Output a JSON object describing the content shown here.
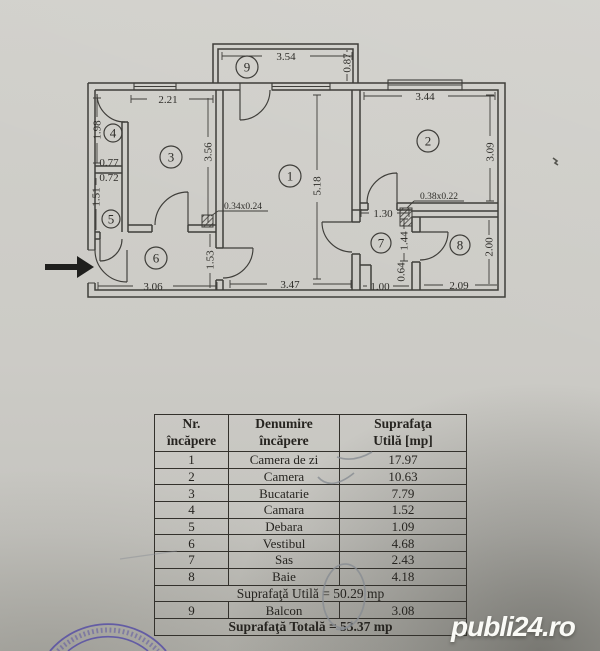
{
  "colors": {
    "paper": "#cbcac5",
    "ink": "#3f3e3a",
    "pen": "#878c92",
    "stamp": "#574fa4",
    "wm": "#fafaf6"
  },
  "watermark": {
    "text": "publi24.ro"
  },
  "plan": {
    "rooms": {
      "r1": "1",
      "r2": "2",
      "r3": "3",
      "r4": "4",
      "r5": "5",
      "r6": "6",
      "r7": "7",
      "r8": "8",
      "r9": "9"
    },
    "dims": {
      "balcony_width": "3.54",
      "balcony_depth": "0.87",
      "kitchen_width": "2.21",
      "kitchen_height": "3.56",
      "camara_height": "1.98",
      "camara_width": "0.77",
      "debara_width": "0.72",
      "debara_height": "1.51",
      "living_height": "5.18",
      "living_width": "3.47",
      "camera_width": "3.44",
      "camera_height": "3.09",
      "shaft_a": "0.34x0.24",
      "shaft_b": "0.38x0.22",
      "sas_width": "1.30",
      "sas_height_upper": "1.44",
      "sas_height_lower": "0.64",
      "sas_bottom_width": "1.00",
      "bath_width": "2.09",
      "bath_height": "2.00",
      "vestibul_height": "1.53",
      "vestibul_width": "3.06"
    }
  },
  "table": {
    "headers": [
      {
        "line1": "Nr.",
        "line2": "încăpere"
      },
      {
        "line1": "Denumire",
        "line2": "încăpere"
      },
      {
        "line1": "Suprafaţa",
        "line2": "Utilă [mp]"
      }
    ],
    "rows": [
      {
        "nr": "1",
        "name": "Camera de zi",
        "area": "17.97"
      },
      {
        "nr": "2",
        "name": "Camera",
        "area": "10.63"
      },
      {
        "nr": "3",
        "name": "Bucatarie",
        "area": "7.79"
      },
      {
        "nr": "4",
        "name": "Camara",
        "area": "1.52"
      },
      {
        "nr": "5",
        "name": "Debara",
        "area": "1.09"
      },
      {
        "nr": "6",
        "name": "Vestibul",
        "area": "4.68"
      },
      {
        "nr": "7",
        "name": "Sas",
        "area": "2.43"
      },
      {
        "nr": "8",
        "name": "Baie",
        "area": "4.18"
      }
    ],
    "subtotal": "Suprafaţă Utilă = 50.29 mp",
    "balcony_row": {
      "nr": "9",
      "name": "Balcon",
      "area": "3.08"
    },
    "total": "Suprafaţă Totală = 53.37 mp"
  }
}
